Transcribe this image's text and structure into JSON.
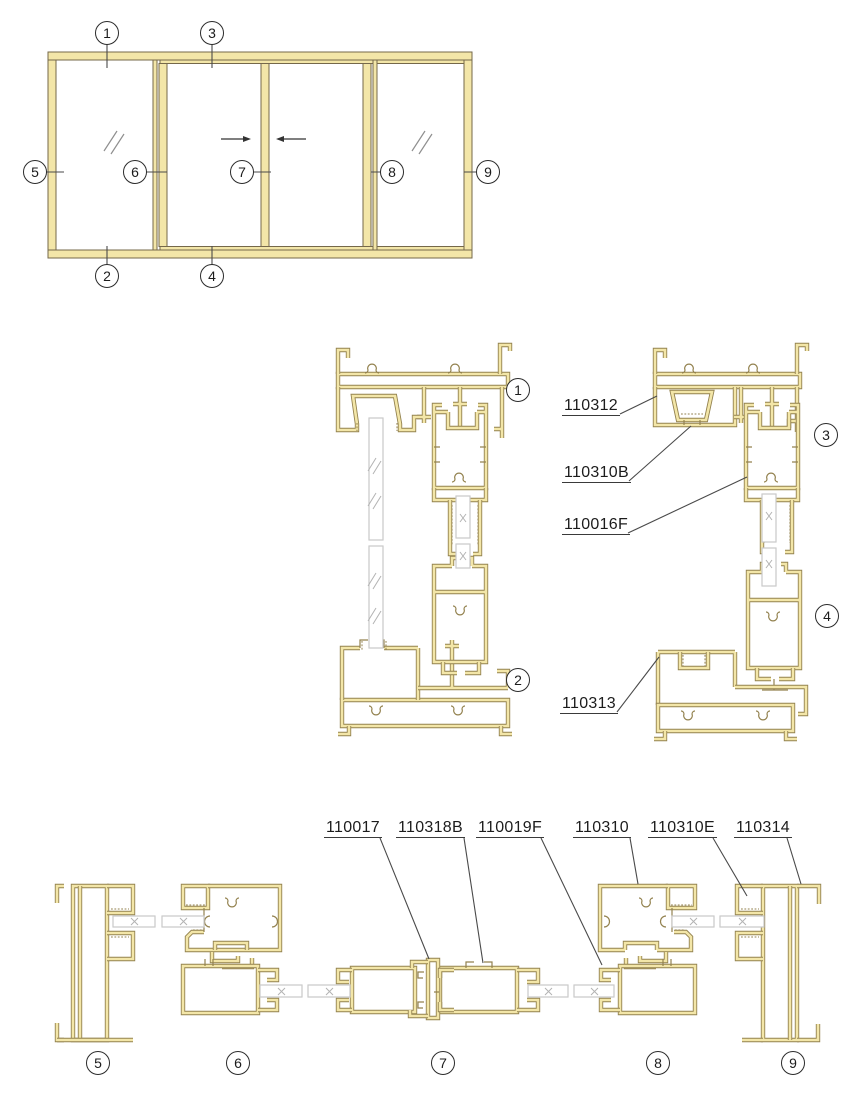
{
  "colors": {
    "profile_edge": "#93824F",
    "profile_fill": "#F3E6A8",
    "elevation_fill": "#F3E6A8",
    "glass_edge": "#C9C9C9",
    "line": "#4A4A4A",
    "text": "#1C1C1C"
  },
  "elevation": {
    "badges": {
      "b1": "1",
      "b2": "2",
      "b3": "3",
      "b4": "4",
      "b5": "5",
      "b6": "6",
      "b7": "7",
      "b8": "8",
      "b9": "9"
    }
  },
  "section_badges": {
    "s1": "1",
    "s2": "2",
    "s3": "3",
    "s4": "4",
    "s5": "5",
    "s6": "6",
    "s7": "7",
    "s8": "8",
    "s9": "9"
  },
  "part_labels": {
    "p110312": "110312",
    "p110310B": "110310B",
    "p110016F": "110016F",
    "p110313": "110313",
    "p110017": "110017",
    "p110318B": "110318B",
    "p110019F": "110019F",
    "p110310": "110310",
    "p110310E": "110310E",
    "p110314": "110314"
  }
}
